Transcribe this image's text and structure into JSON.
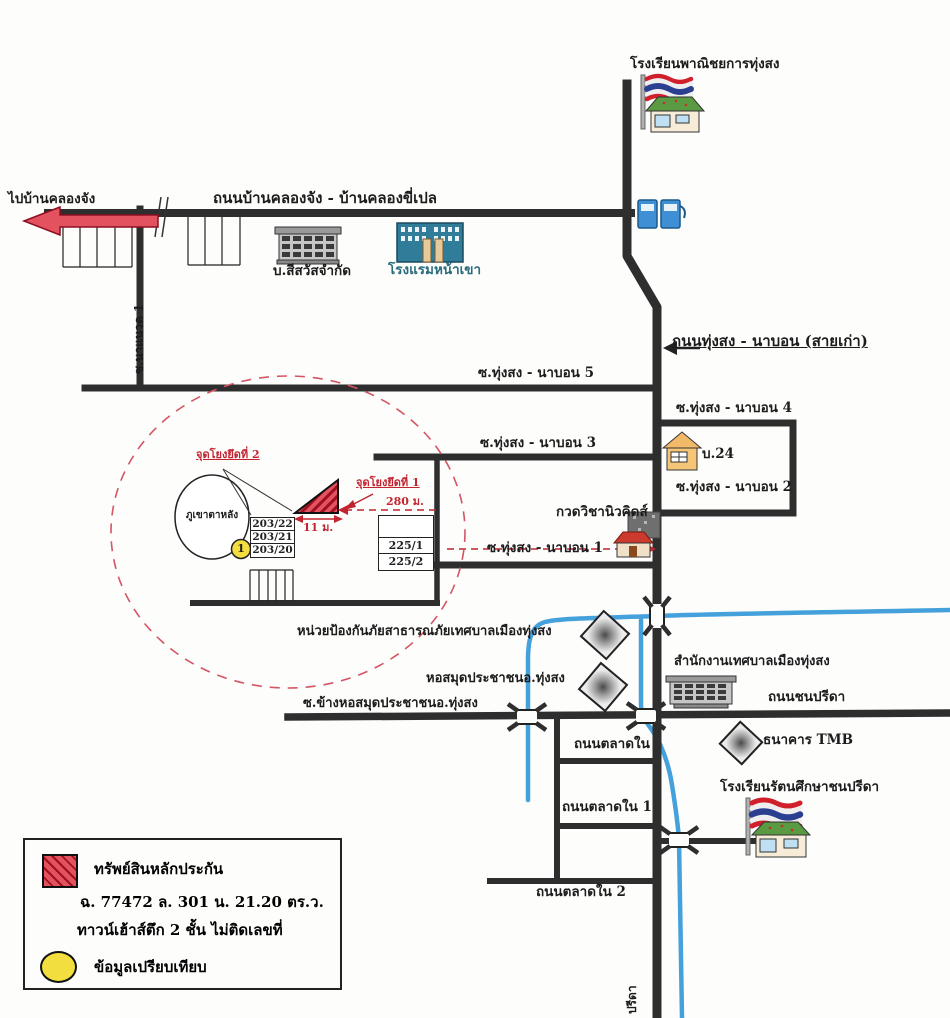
{
  "colors": {
    "road": "#2e2e2e",
    "canal": "#45a1dc",
    "highlight_red": "#c2252f",
    "marker_yellow": "#f2de3f",
    "hatch_red": "#e2525f"
  },
  "map": {
    "top": {
      "commercial_school_label": "โรงเรียนพาณิชยการทุ่งสง",
      "to_ban_khlong_chang": "ไปบ้านคลองจัง",
      "khlong_chang_road": "ถนนบ้านคลองจัง - บ้านคลองขี่เปล",
      "soi_label_vertical": "ซ.นาแนวด 1",
      "sisawat_company": "บ.สีสวัสจำกัด",
      "na_khao_hotel": "โรงแรมหน้าเขา"
    },
    "middle": {
      "old_road": "ถนนทุ่งสง - นาบอน (สายเก่า)",
      "soi5": "ซ.ทุ่งสง - นาบอน 5",
      "soi4": "ซ.ทุ่งสง - นาบอน 4",
      "soi3": "ซ.ทุ่งสง - นาบอน 3",
      "soi2": "ซ.ทุ่งสง - นาบอน 2",
      "soi1": "ซ.ทุ่งสง - นาบอน 1",
      "house_24": "บ.24",
      "newkids_tutor": "กวดวิชานิวคิดส์"
    },
    "property_area": {
      "anchor_point_2": "จุดโยงยึดที่ 2",
      "anchor_point_1": "จุดโยงยึดที่ 1",
      "distance_280": "280 ม.",
      "distance_11": "11 ม.",
      "mountain": "ภูเขาตาหลัง",
      "parcel_203_22": "203/22",
      "parcel_203_21": "203/21",
      "parcel_203_20": "203/20",
      "parcel_225_1": "225/1",
      "parcel_225_2": "225/2",
      "comparison_marker": "1"
    },
    "south": {
      "fire_prevention_unit": "หน่วยป้องกันภัยสาธารณภัยเทศบาลเมืองทุ่งสง",
      "public_library": "หอสมุดประชาชนอ.ทุ่งสง",
      "library_side_soi": "ซ.ข้างหอสมุดประชาชนอ.ทุ่งสง",
      "municipality_office": "สำนักงานเทศบาลเมืองทุ่งสง",
      "chon_preeda_road": "ถนนชนปรีดา",
      "tmb_bank": "ธนาคาร TMB",
      "talat_nai_road": "ถนนตลาดใน",
      "talat_nai_1_road": "ถนนตลาดใน 1",
      "talat_nai_2_road": "ถนนตลาดใน 2",
      "rattana_school": "โรงเรียนรัตนศึกษาชนปรีดา",
      "bottom_road_vertical": "ปรีดา"
    }
  },
  "legend": {
    "collateral": "ทรัพย์สินหลักประกัน",
    "deed_info": "ฉ. 77472 ล. 301 น. 21.20 ตร.ว.",
    "building_info": "ทาวน์เฮ้าส์ตึก 2 ชั้น ไม่ติดเลขที่",
    "comparison": "ข้อมูลเปรียบเทียบ"
  }
}
